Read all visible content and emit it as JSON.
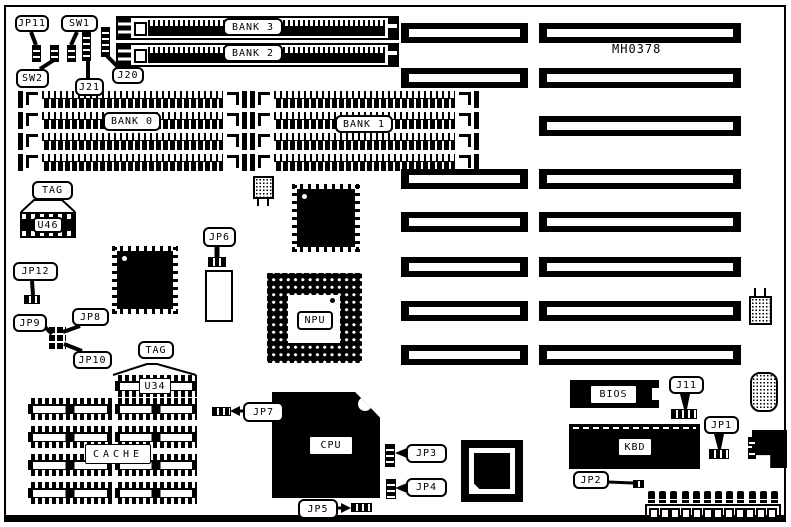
{
  "diagram_title": "motherboard-layout",
  "labels": {
    "jp11": "JP11",
    "sw1": "SW1",
    "sw2": "SW2",
    "j21": "J21",
    "j20": "J20",
    "bank3": "BANK 3",
    "bank2": "BANK 2",
    "bank0": "BANK 0",
    "bank1": "BANK 1",
    "part_number": "MH0378",
    "tag_top": "TAG",
    "u46": "U46",
    "jp12": "JP12",
    "jp9": "JP9",
    "jp8": "JP8",
    "jp10": "JP10",
    "jp6": "JP6",
    "npu": "NPU",
    "tag_bottom": "TAG",
    "u34": "U34",
    "cache": "CACHE",
    "jp7": "JP7",
    "cpu": "CPU",
    "jp5": "JP5",
    "jp3": "JP3",
    "jp4": "JP4",
    "bios": "BIOS",
    "j11": "J11",
    "kbd": "KBD",
    "jp1": "JP1",
    "jp2": "JP2"
  },
  "colors": {
    "ink": "#000000",
    "paper": "#ffffff"
  }
}
